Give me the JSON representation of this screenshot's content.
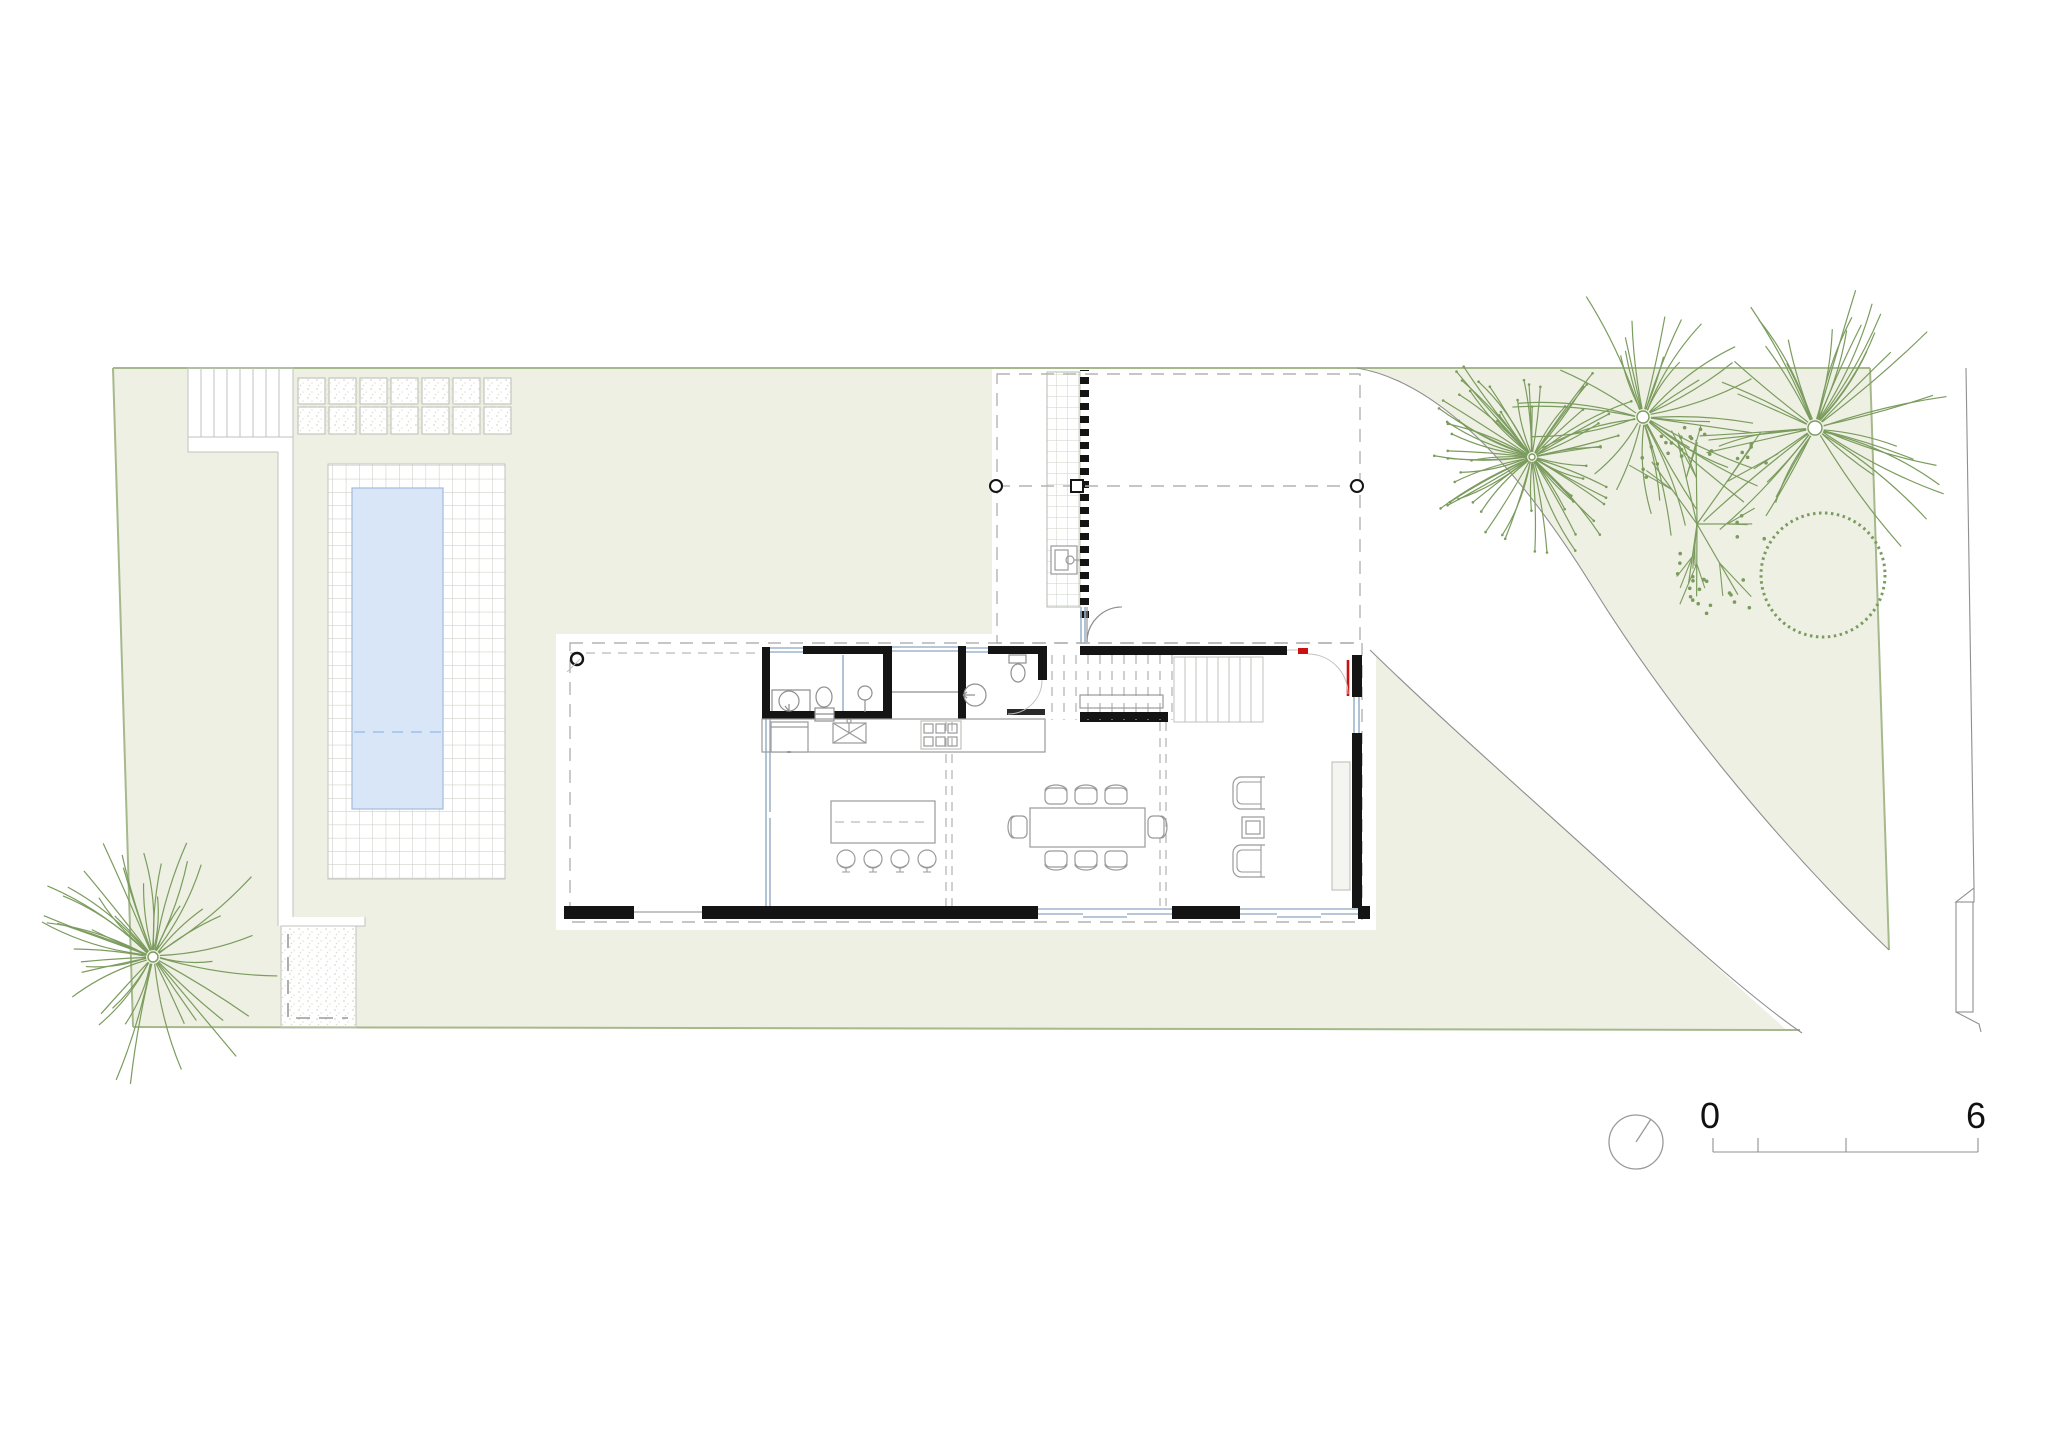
{
  "drawing": {
    "kind": "architectural site and ground-floor plan",
    "visible_text": [
      "0",
      "6"
    ]
  },
  "colors": {
    "site_fill": "#eef0e3",
    "site_boundary": "#a6b98c",
    "line_gray": "#8f8f8f",
    "line_light": "#c2c2bd",
    "wall": "#141414",
    "glass": "#9fb4cc",
    "water_fill": "#d9e6f8",
    "water_edge": "#a4bbd9",
    "water_dash": "#9cc0e8",
    "tree": "#7b9c5e",
    "accent_red": "#cc1111",
    "ink": "#111111",
    "tile": "#c8ccc2",
    "stipple": "#d9d9d1"
  },
  "scale_bar": {
    "start_label": "0",
    "end_label": "6",
    "tick_values_m": [
      0,
      1,
      3,
      6
    ],
    "length_m": 6
  },
  "compass": {
    "style": "circle-with-needle",
    "needle_direction": "north-northeast"
  },
  "site_features": [
    "garden-lawn",
    "swimming-pool",
    "pool-deck-tiles",
    "paving-slabs",
    "entry-steps",
    "side-path",
    "service-pad",
    "curved-driveway",
    "street-edge",
    "upper-floor-dashed-outline",
    "timber-walkway",
    "hatched-edge-band"
  ],
  "house_features": [
    "open-terrace",
    "corner-column",
    "bathroom-sink",
    "toilet",
    "shower-column",
    "laundry-bench",
    "wc-toilet",
    "wc-shower",
    "kitchen-counter",
    "fridge",
    "kitchen-sink",
    "cooktop-6-burners",
    "kitchen-island",
    "bar-stools-4",
    "dining-table-8-chairs",
    "armchairs-2",
    "side-table",
    "sideboard",
    "staircase-lower-flight",
    "staircase-upper-flight-dashed",
    "entry-door-red",
    "window-bands",
    "roof-overhang-dashed"
  ],
  "trees": [
    {
      "name": "palm-tree-southwest",
      "type": "palm",
      "cx": 153,
      "cy": 957,
      "rays": 46,
      "rmin": 55,
      "rmax": 130,
      "seed": 7,
      "trunk_r": 5
    },
    {
      "name": "palm-tree-dense-north",
      "type": "palm-dense",
      "cx": 1532,
      "cy": 457,
      "rays": 62,
      "rmin": 50,
      "rmax": 115,
      "seed": 11,
      "trunk_r": 3
    },
    {
      "name": "palm-tree-north-center",
      "type": "palm",
      "cx": 1643,
      "cy": 417,
      "rays": 34,
      "rmin": 50,
      "rmax": 135,
      "seed": 23,
      "trunk_r": 6
    },
    {
      "name": "palm-tree-northeast",
      "type": "palm",
      "cx": 1815,
      "cy": 428,
      "rays": 40,
      "rmin": 70,
      "rmax": 150,
      "seed": 31,
      "trunk_r": 7
    },
    {
      "name": "flowering-tree",
      "type": "flower",
      "cx": 1697,
      "cy": 524,
      "branches": 9,
      "rmin": 40,
      "rmax": 95,
      "seed": 43
    },
    {
      "name": "tree-canopy-outline",
      "type": "dotted-circle",
      "cx": 1823,
      "cy": 575,
      "r": 62
    }
  ]
}
